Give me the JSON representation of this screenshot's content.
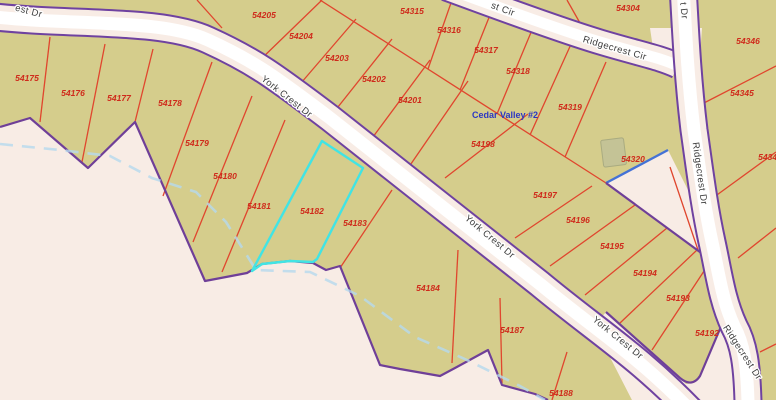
{
  "map": {
    "colors": {
      "background": "#f8ece5",
      "parcel_fill": "#d5cd8c",
      "lot_line": "#e0462e",
      "boundary": "#6f3f98",
      "road_casing": "#6f42a0",
      "road_fill": "#ffffff",
      "parcel_label": "#cf2a1b",
      "street_label": "#3d3d3d",
      "stream": "#b5d9ee",
      "highlight": "#41e4e4",
      "water_edge": "#4472d6",
      "subdivision_label": "#2b36c3",
      "building_fill": "#c4c396"
    },
    "selected_parcel": "54182",
    "subdivision": {
      "text": "Cedar Valley #2",
      "x": 505,
      "y": 118
    },
    "parcel_labels": [
      {
        "id": "54175",
        "x": 27,
        "y": 81
      },
      {
        "id": "54176",
        "x": 73,
        "y": 96
      },
      {
        "id": "54177",
        "x": 119,
        "y": 101
      },
      {
        "id": "54178",
        "x": 170,
        "y": 106
      },
      {
        "id": "54179",
        "x": 197,
        "y": 146
      },
      {
        "id": "54180",
        "x": 225,
        "y": 179
      },
      {
        "id": "54181",
        "x": 259,
        "y": 209
      },
      {
        "id": "54182",
        "x": 312,
        "y": 214
      },
      {
        "id": "54183",
        "x": 355,
        "y": 226
      },
      {
        "id": "54184",
        "x": 428,
        "y": 291
      },
      {
        "id": "54187",
        "x": 512,
        "y": 333
      },
      {
        "id": "54188",
        "x": 561,
        "y": 396
      },
      {
        "id": "54192",
        "x": 707,
        "y": 336
      },
      {
        "id": "54193",
        "x": 678,
        "y": 301
      },
      {
        "id": "54194",
        "x": 645,
        "y": 276
      },
      {
        "id": "54195",
        "x": 612,
        "y": 249
      },
      {
        "id": "54196",
        "x": 578,
        "y": 223
      },
      {
        "id": "54197",
        "x": 545,
        "y": 198
      },
      {
        "id": "54198",
        "x": 483,
        "y": 147
      },
      {
        "id": "54201",
        "x": 410,
        "y": 103
      },
      {
        "id": "54202",
        "x": 374,
        "y": 82
      },
      {
        "id": "54203",
        "x": 337,
        "y": 61
      },
      {
        "id": "54204",
        "x": 301,
        "y": 39
      },
      {
        "id": "54205",
        "x": 264,
        "y": 18
      },
      {
        "id": "54304",
        "x": 628,
        "y": 11
      },
      {
        "id": "54315",
        "x": 412,
        "y": 14
      },
      {
        "id": "54316",
        "x": 449,
        "y": 33
      },
      {
        "id": "54317",
        "x": 486,
        "y": 53
      },
      {
        "id": "54318",
        "x": 518,
        "y": 74
      },
      {
        "id": "54319",
        "x": 570,
        "y": 110
      },
      {
        "id": "54320",
        "x": 633,
        "y": 162
      },
      {
        "id": "54343",
        "x": 770,
        "y": 160
      },
      {
        "id": "54345",
        "x": 742,
        "y": 96
      },
      {
        "id": "54346",
        "x": 748,
        "y": 44
      }
    ],
    "street_labels": [
      {
        "text": "est Dr",
        "x": 28,
        "y": 14,
        "rot": 15
      },
      {
        "text": "York Crest Dr",
        "x": 285,
        "y": 99,
        "rot": 38
      },
      {
        "text": "York Crest Dr",
        "x": 488,
        "y": 239,
        "rot": 40
      },
      {
        "text": "York Crest Dr",
        "x": 616,
        "y": 340,
        "rot": 39
      },
      {
        "text": "st Cir",
        "x": 502,
        "y": 12,
        "rot": 20
      },
      {
        "text": "Ridgecrest Cir",
        "x": 614,
        "y": 51,
        "rot": 16
      },
      {
        "text": "t Dr",
        "x": 681,
        "y": 11,
        "rot": 84
      },
      {
        "text": "Ridgecrest Dr",
        "x": 697,
        "y": 174,
        "rot": 82
      },
      {
        "text": "Ridgecrest Dr",
        "x": 740,
        "y": 354,
        "rot": 57
      }
    ]
  }
}
